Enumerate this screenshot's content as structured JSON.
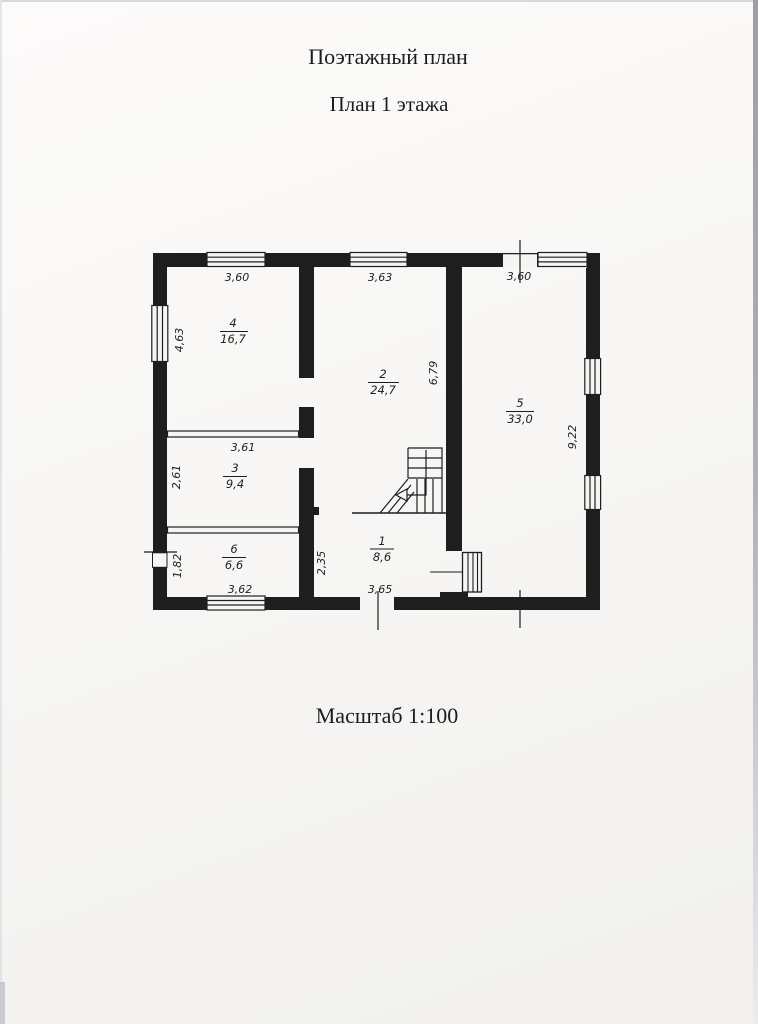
{
  "page": {
    "title": "Поэтажный план",
    "subtitle": "План 1 этажа",
    "scale_label": "Масштаб 1:100"
  },
  "floor_plan": {
    "rooms": {
      "r1": {
        "number": "1",
        "area": "8,6"
      },
      "r2": {
        "number": "2",
        "area": "24,7"
      },
      "r3": {
        "number": "3",
        "area": "9,4"
      },
      "r4": {
        "number": "4",
        "area": "16,7"
      },
      "r5": {
        "number": "5",
        "area": "33,0"
      },
      "r6": {
        "number": "6",
        "area": "6,6"
      }
    },
    "dims": {
      "top_room4": "3,60",
      "top_room2": "3,63",
      "top_room5": "3,60",
      "left_room4": "4,63",
      "left_room3": "2,61",
      "left_room6": "1,82",
      "room3_top": "3,61",
      "bottom_room6": "3,62",
      "bottom_room1": "3,65",
      "room1_left": "2,35",
      "room2_right": "6,79",
      "right_room5": "9,22"
    }
  },
  "colors": {
    "ink": "#1e1e1e",
    "paper": "#f6f5f3"
  }
}
